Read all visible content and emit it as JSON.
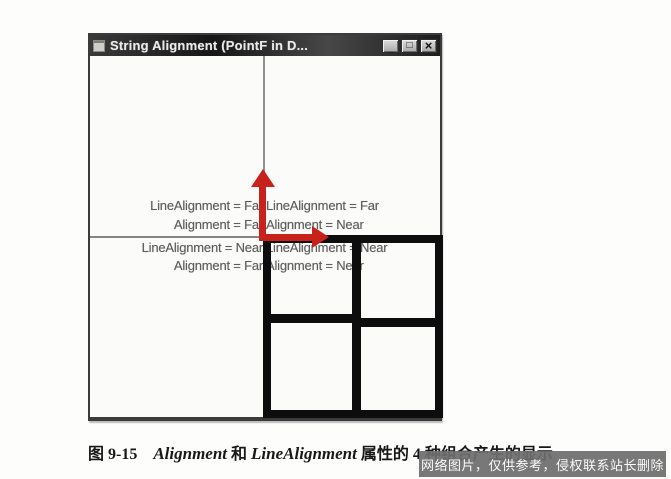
{
  "window": {
    "title": "String Alignment (PointF in D...",
    "controls": {
      "minimize_glyph": "_",
      "maximize_glyph": "□",
      "close_glyph": "×"
    }
  },
  "quadrant_labels": {
    "top_left": {
      "line1": "LineAlignment = Far",
      "line2": "Alignment = Far"
    },
    "top_right": {
      "line1": "LineAlignment = Far",
      "line2": "Alignment = Near"
    },
    "bottom_left": {
      "line1": "LineAlignment = Near",
      "line2": "Alignment = Far"
    },
    "bottom_right": {
      "line1": "LineAlignment = Near",
      "line2": "Alignment = Near"
    }
  },
  "annotations": {
    "up_arrow": "red-arrow-up",
    "right_arrow": "red-arrow-right",
    "arrow_color": "#c8231a",
    "grid_color": "#0d0d0d",
    "grid_cells": 4
  },
  "caption": {
    "figure_label": "图 9-15",
    "term1": "Alignment",
    "conj": " 和 ",
    "term2": "LineAlignment",
    "suffix": " 属性的 4 种组合产生的显示"
  },
  "watermark": {
    "text": "网络图片，仅供参考，侵权联系站长删除",
    "bg_color": "#6e6e6e"
  }
}
